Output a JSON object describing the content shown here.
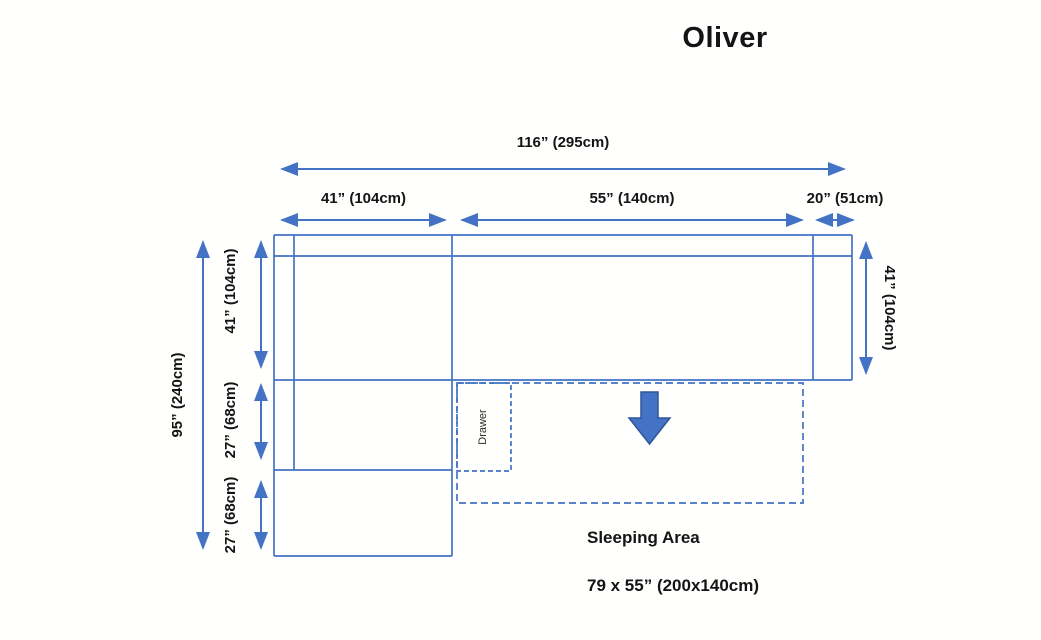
{
  "title": "Oliver",
  "colors": {
    "line_blue": "#4472C4",
    "arrow_fill": "#4472C4",
    "arrow_border": "#2E5697",
    "text": "#141414"
  },
  "dimensions": {
    "top_total": {
      "label": "116” (295cm)"
    },
    "top_left": {
      "label": "41” (104cm)"
    },
    "top_middle": {
      "label": "55” (140cm)"
    },
    "top_right": {
      "label": "20” (51cm)"
    },
    "left_total": {
      "label": "95” (240cm)"
    },
    "left_upper": {
      "label": "41” (104cm)"
    },
    "left_mid": {
      "label": "27” (68cm)"
    },
    "left_lower": {
      "label": "27” (68cm)"
    },
    "right_side": {
      "label": "41” (104cm)"
    }
  },
  "annotations": {
    "drawer": "Drawer",
    "sleeping_area": "Sleeping Area",
    "sleeping_size": "79 x 55” (200x140cm)"
  }
}
